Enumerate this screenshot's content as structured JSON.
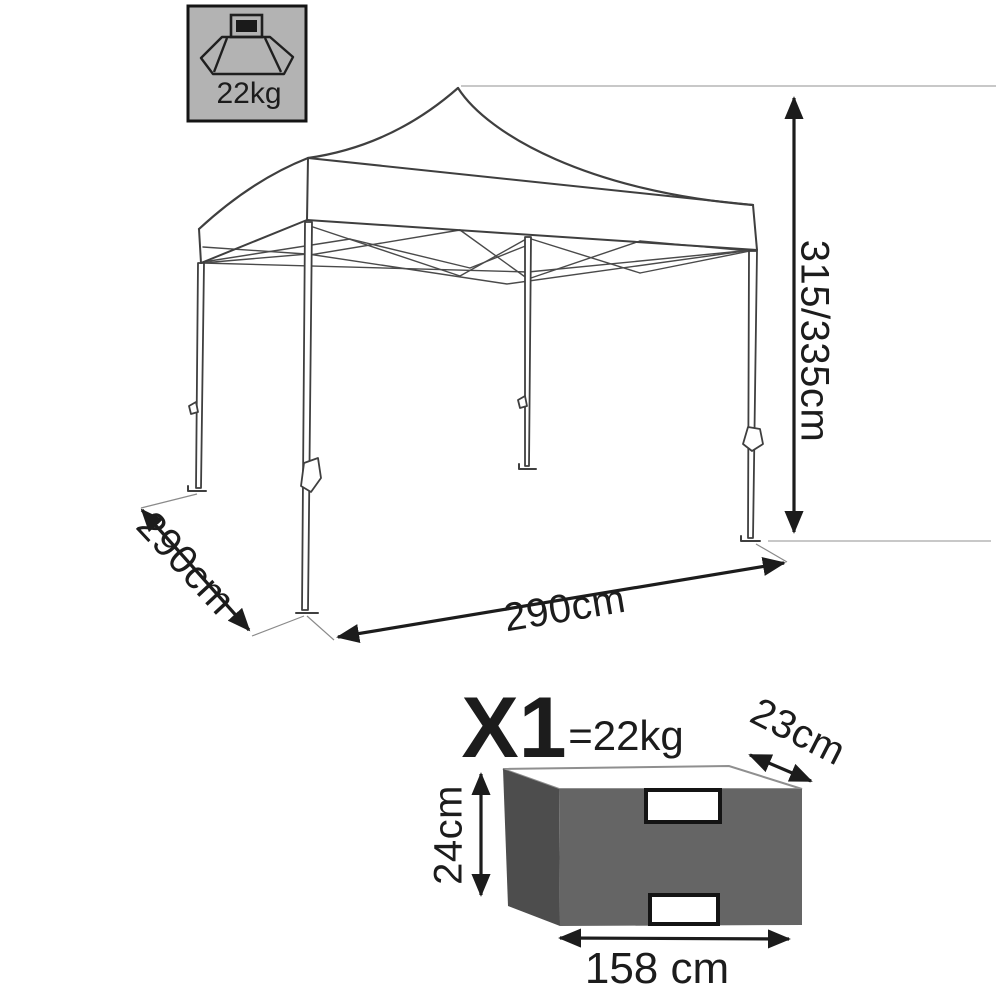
{
  "badge": {
    "weight_label": "22kg",
    "icon": "packed-weight-icon"
  },
  "tent": {
    "height_label": "315/335cm",
    "depth_label": "290cm",
    "width_label": "290cm"
  },
  "package": {
    "quantity_label": "X1",
    "weight_label": "=22kg",
    "depth_label": "23cm",
    "height_label": "24cm",
    "width_label": "158 cm"
  },
  "colors": {
    "line": "#3f3f3f",
    "dimension": "#1c1c1c",
    "badge_fill": "#b3b3b3",
    "badge_border": "#141414",
    "bag_front": "#656565",
    "bag_side": "#4d4d4d",
    "bag_top": "#ffffff",
    "bag_top_edge": "#8f8f8f",
    "handle_fill": "#ffffff",
    "handle_border": "#141414"
  }
}
